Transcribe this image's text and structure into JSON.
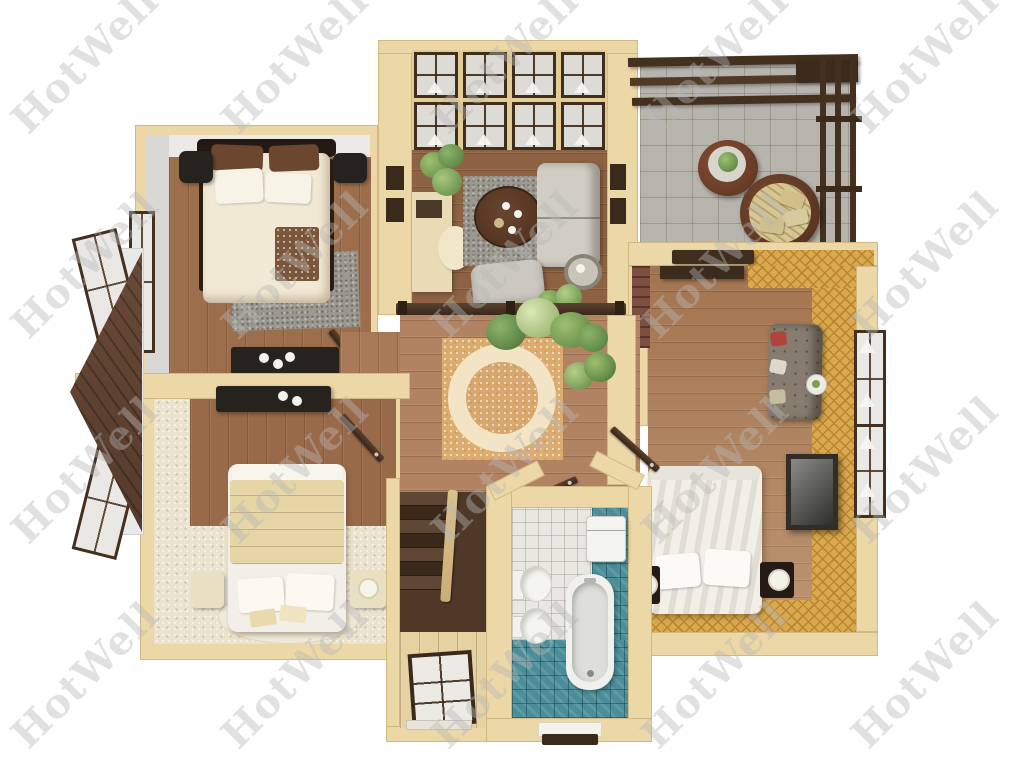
{
  "watermark": {
    "text": "HotWell",
    "color": "rgba(184,184,184,0.42)",
    "font_size_px": 40,
    "rotation_deg": -45,
    "positions": [
      [
        85,
        60
      ],
      [
        295,
        60
      ],
      [
        505,
        60
      ],
      [
        715,
        60
      ],
      [
        925,
        60
      ],
      [
        85,
        265
      ],
      [
        295,
        265
      ],
      [
        505,
        265
      ],
      [
        715,
        265
      ],
      [
        925,
        265
      ],
      [
        85,
        470
      ],
      [
        295,
        470
      ],
      [
        505,
        470
      ],
      [
        715,
        470
      ],
      [
        925,
        470
      ],
      [
        85,
        675
      ],
      [
        295,
        675
      ],
      [
        505,
        675
      ],
      [
        715,
        675
      ],
      [
        925,
        675
      ]
    ]
  },
  "colors": {
    "wall": "#ecd7a6",
    "innerwall": "#ebeae6",
    "graywall": "#d9d8d4",
    "woodtl": "#9c6e4c",
    "woodbl": "#996a49",
    "woodhall": "#b28363",
    "woodlr": "#a3744f",
    "woodsun": "#8d6243",
    "entry": "#e5d2a2",
    "carpet": "#eae3d0",
    "gold": "#d9a94f",
    "goldp": "#bb862e",
    "teal": "#4b8e99",
    "wtile": "#e9e7e1",
    "stone": "#b6b4ac",
    "dkwood": "#43301f",
    "roofa": "#6a4a38",
    "roofb": "#553a2b",
    "ruggray": "#9b988f",
    "rugtan": "#dcab6e",
    "rugring": "#f2e4c4",
    "rugctr": "#d7a76e",
    "sofagray": "#d0cdc4",
    "sofabrown": "#877c6f",
    "bedcream": "#f1e9d4",
    "bedwhite": "#f2efe8",
    "blanket": "#e6d6a6",
    "pillowbrown": "#6b4730",
    "blackfurn": "#26221e",
    "creamfurn": "#e9dfc2",
    "green": "#6f9a4d",
    "greenlt": "#c6d9a0",
    "rattan": "#6e4028",
    "cushion": "#d6c690",
    "brick": "#7d4f41",
    "stairdark": "#4e3828",
    "tread": "#5f4533",
    "riser": "#3a291b",
    "railing": "#d9c08c"
  },
  "scene": {
    "type": "3d-floor-plan-render",
    "floor": "single level, top-down view",
    "rooms": [
      {
        "id": "bedroom-top-left",
        "label": "master bedroom",
        "furniture": [
          "double bed with brown pillows",
          "two black nightstands",
          "black dresser with plates",
          "gray shag rug",
          "window",
          "porch bay"
        ]
      },
      {
        "id": "sunroom",
        "label": "sunroom / winter garden",
        "furniture": [
          "glass skylight roof",
          "gray sofa",
          "armchair",
          "round coffee table with cups",
          "gray shag rug",
          "potted plants",
          "cream cabinet",
          "wood railing"
        ]
      },
      {
        "id": "terrace",
        "label": "open terrace",
        "furniture": [
          "pergola beams",
          "slat fence",
          "stone tile floor",
          "rattan table with plant",
          "round rattan daybed with cushions"
        ]
      },
      {
        "id": "hallway",
        "label": "central hall",
        "furniture": [
          "square area rug with circle motif",
          "potted plants",
          "interior doors",
          "staircase access"
        ]
      },
      {
        "id": "living-area",
        "label": "living / bedroom suite",
        "furniture": [
          "tufted sofa with pillows",
          "side table",
          "TV wardrobe",
          "double white bed",
          "nightstands with lamps",
          "gold damask carpet",
          "tall windows",
          "brick fireplace strip"
        ]
      },
      {
        "id": "bedroom-bottom-left",
        "label": "bedroom",
        "furniture": [
          "double bed with beige blanket",
          "cream nightstands",
          "round rug",
          "black dresser",
          "textured carpet"
        ]
      },
      {
        "id": "bathroom",
        "label": "bathroom",
        "furniture": [
          "toilet",
          "bidet",
          "bathtub",
          "washing machine",
          "teal tile floor",
          "window bench"
        ]
      },
      {
        "id": "stair-entry",
        "label": "staircase and entry",
        "furniture": [
          "dark wood stairs",
          "light railing",
          "front door with glass panes"
        ]
      }
    ]
  }
}
